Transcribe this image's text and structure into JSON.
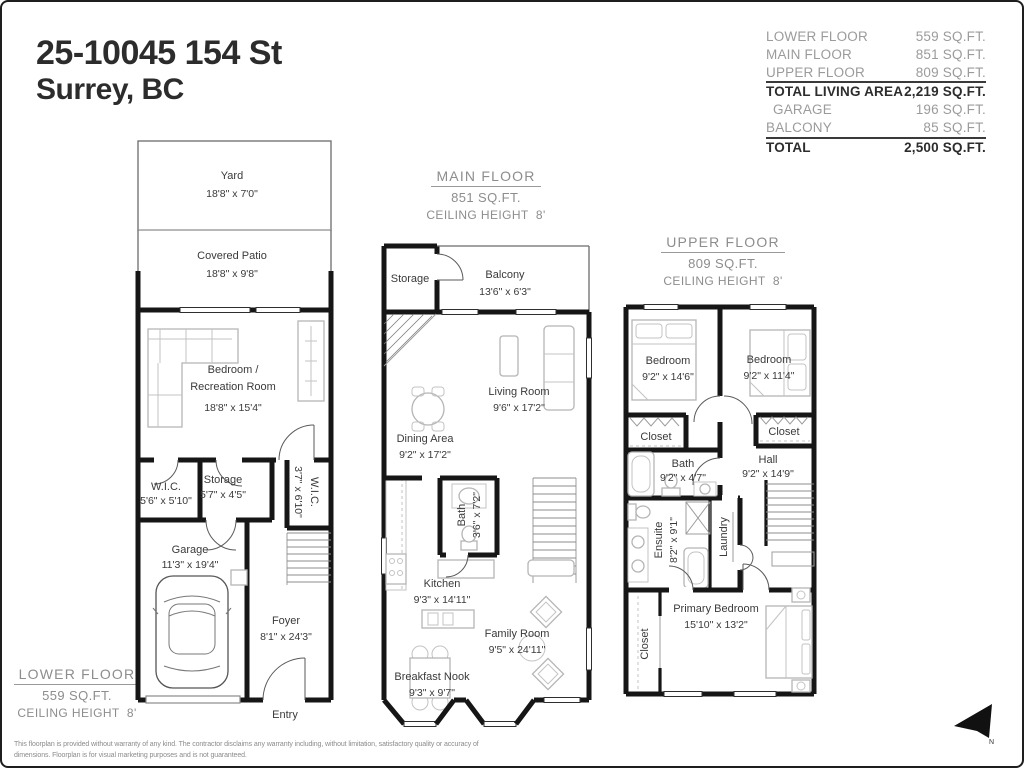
{
  "colors": {
    "wall": "#161616",
    "label": "#3a3a3a",
    "muted": "#8d8d8d"
  },
  "header": {
    "address_line1": "25-10045 154 St",
    "address_line2": "Surrey, BC"
  },
  "summary": {
    "rows": [
      {
        "label": "LOWER FLOOR",
        "value": "559 SQ.FT."
      },
      {
        "label": "MAIN FLOOR",
        "value": "851 SQ.FT."
      },
      {
        "label": "UPPER FLOOR",
        "value": "809 SQ.FT."
      },
      {
        "label": "TOTAL LIVING AREA",
        "value": "2,219 SQ.FT."
      },
      {
        "label": "GARAGE",
        "value": "196 SQ.FT."
      },
      {
        "label": "BALCONY",
        "value": "85 SQ.FT."
      },
      {
        "label": "TOTAL",
        "value": "2,500 SQ.FT."
      }
    ]
  },
  "floors": {
    "lower": {
      "caption": {
        "title": "LOWER FLOOR",
        "area": "559 SQ.FT.",
        "ceiling": "CEILING HEIGHT  8'"
      },
      "rooms": {
        "yard": {
          "name": "Yard",
          "dims": "18'8\" x 7'0\""
        },
        "patio": {
          "name": "Covered Patio",
          "dims": "18'8\" x 9'8\""
        },
        "rec": {
          "name1": "Bedroom /",
          "name2": "Recreation Room",
          "dims": "18'8\" x 15'4\""
        },
        "wic_left": {
          "name": "W.I.C.",
          "dims": "5'6\" x 5'10\""
        },
        "storage": {
          "name": "Storage",
          "dims": "5'7\" x 4'5\""
        },
        "wic_right": {
          "name": "W.I.C.",
          "dims": "3'7\" x 6'10\""
        },
        "garage": {
          "name": "Garage",
          "dims": "11'3\" x 19'4\""
        },
        "foyer": {
          "name": "Foyer",
          "dims": "8'1\" x 24'3\""
        },
        "entry": {
          "name": "Entry"
        }
      }
    },
    "main": {
      "caption": {
        "title": "MAIN FLOOR",
        "area": "851 SQ.FT.",
        "ceiling": "CEILING HEIGHT  8'"
      },
      "rooms": {
        "storage": {
          "name": "Storage"
        },
        "balcony": {
          "name": "Balcony",
          "dims": "13'6\" x 6'3\""
        },
        "living": {
          "name": "Living Room",
          "dims": "9'6\" x 17'2\""
        },
        "dining": {
          "name": "Dining Area",
          "dims": "9'2\" x 17'2\""
        },
        "bath": {
          "name": "Bath",
          "dims": "3'6\" x 7'2\""
        },
        "kitchen": {
          "name": "Kitchen",
          "dims": "9'3\" x 14'11\""
        },
        "family": {
          "name": "Family Room",
          "dims": "9'5\" x 24'11\""
        },
        "nook": {
          "name": "Breakfast Nook",
          "dims": "9'3\" x 9'7\""
        }
      }
    },
    "upper": {
      "caption": {
        "title": "UPPER  FLOOR",
        "area": "809 SQ.FT.",
        "ceiling": "CEILING HEIGHT  8'"
      },
      "rooms": {
        "bedroom_left": {
          "name": "Bedroom",
          "dims": "9'2\" x 14'6\""
        },
        "bedroom_right": {
          "name": "Bedroom",
          "dims": "9'2\" x 11'4\""
        },
        "closet_left": {
          "name": "Closet"
        },
        "closet_right": {
          "name": "Closet"
        },
        "bath": {
          "name": "Bath",
          "dims": "9'2\" x 4'7\""
        },
        "hall": {
          "name": "Hall",
          "dims": "9'2\" x 14'9\""
        },
        "ensuite": {
          "name": "Ensuite",
          "dims": "8'2\" x 9'1\""
        },
        "laundry": {
          "name": "Laundry"
        },
        "primary": {
          "name": "Primary Bedroom",
          "dims": "15'10\" x 13'2\""
        },
        "closet_primary": {
          "name": "Closet"
        }
      }
    }
  },
  "compass": {
    "label": "N"
  },
  "disclaimer": {
    "line1": "This floorplan is provided without warranty of any kind. The contractor disclaims any warranty including, without limitation, satisfactory quality or accuracy of",
    "line2": "dimensions. Floorplan is for visual marketing purposes and is not guaranteed."
  }
}
